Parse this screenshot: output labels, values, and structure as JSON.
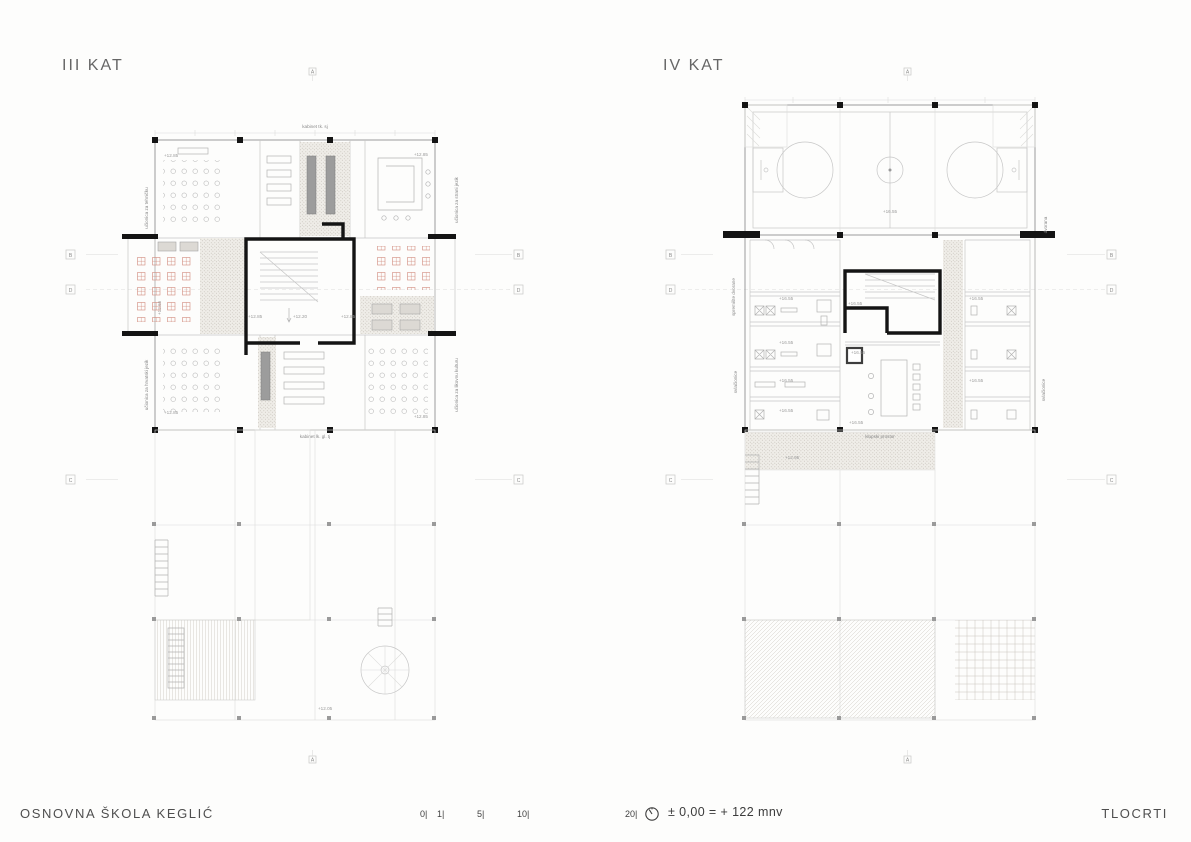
{
  "colors": {
    "walls": "#141414",
    "light_lines": "#c6c6c6",
    "furniture_red": "#cf8272",
    "hatch_dot": "#c7c3ba",
    "text_gray": "#4f4f4f"
  },
  "plans": [
    {
      "title": "III KAT",
      "top_label": "kabinet tk. sj",
      "bottom_label": "kabinet lk. gl. tj",
      "side_labels": {
        "left_top": "učionica za tehničku",
        "left_bottom": "učionica za hrvatski jezik",
        "right_top": "učionica za strani jezik",
        "right_bottom": "učionica za likovnu kulturu"
      },
      "levels": {
        "top_left": "+12.85",
        "top_right": "+12.85",
        "wing": "+12.65",
        "stair_left": "+12.85",
        "stair_center": "+12.20",
        "stair_right": "+12.85",
        "bottom_left": "+12.85",
        "bottom_right": "+12.85",
        "terrace": "+12.05"
      },
      "grid_letters": {
        "a": "A",
        "b": "B",
        "c": "C",
        "d": "D"
      }
    },
    {
      "title": "IV KAT",
      "bottom_label": "klupski prostor",
      "side_labels": {
        "left_top": "spremište dvorane",
        "left_bottom": "svlačionice",
        "right_top": "dvorana",
        "right_bottom": "svlačionice"
      },
      "levels": {
        "hall": "+16.55",
        "stair": "+16.55",
        "corridor": "+16.55",
        "club": "+16.55",
        "left_rooms": [
          "+16.55",
          "+16.55",
          "+16.55",
          "+16.55"
        ],
        "right_rooms": [
          "+16.55",
          "+16.55"
        ],
        "terrace": "+12.95"
      },
      "grid_letters": {
        "a": "A",
        "b": "B",
        "c": "C",
        "d": "D"
      }
    }
  ],
  "footer": {
    "project_title": "OSNOVNA ŠKOLA KEGLIĆ",
    "sheet_title": "TLOCRTI",
    "scale_ticks": [
      "0|",
      "1|",
      "5|",
      "10|",
      "20|"
    ],
    "datum_note": "± 0,00 = + 122 mnv"
  }
}
